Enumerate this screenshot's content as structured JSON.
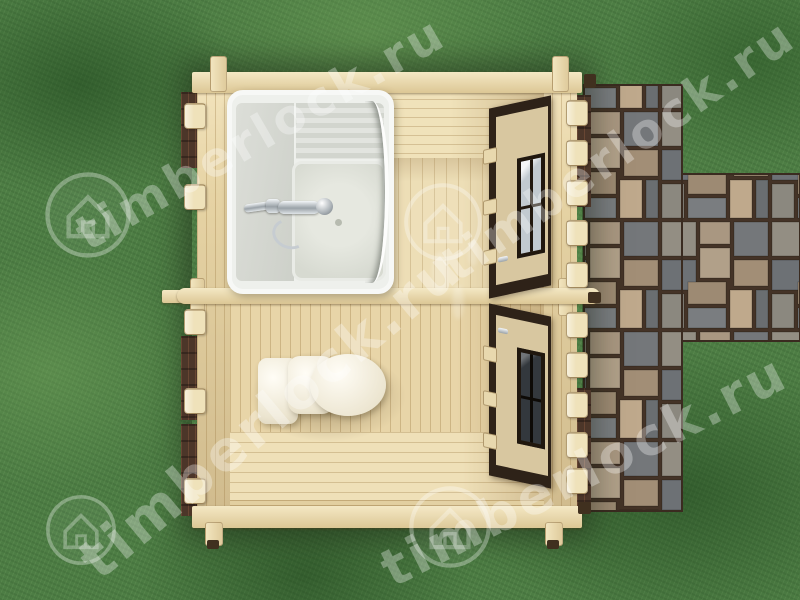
{
  "watermark": {
    "text": "timberlock.ru",
    "logo_icon": "house-in-circle",
    "opacity": "0.32"
  },
  "scene": {
    "view": "top-down cutaway 3d render",
    "building": "two-room wooden cabin",
    "room_top": "shower room",
    "room_bottom": "toilet room",
    "fixtures": [
      "shower cabin with chrome faucet",
      "toilet"
    ],
    "doors": 2,
    "surroundings": [
      "grass lawn",
      "stone paving path"
    ]
  },
  "colors": {
    "grass": "#4d7d44",
    "grass_dark": "#2e5a2c",
    "grass_light": "#77a45e",
    "wood_light": "#f2e5c0",
    "wood_mid": "#e8d6aa",
    "wood_dark": "#c9af7e",
    "door_frame": "#2e2218",
    "door_leaf": "#d8c7a0",
    "stone_grout": "#443327",
    "shower_white": "#eef0ec",
    "toilet_white": "#f8f4e9",
    "watermark_white": "#ffffff"
  }
}
